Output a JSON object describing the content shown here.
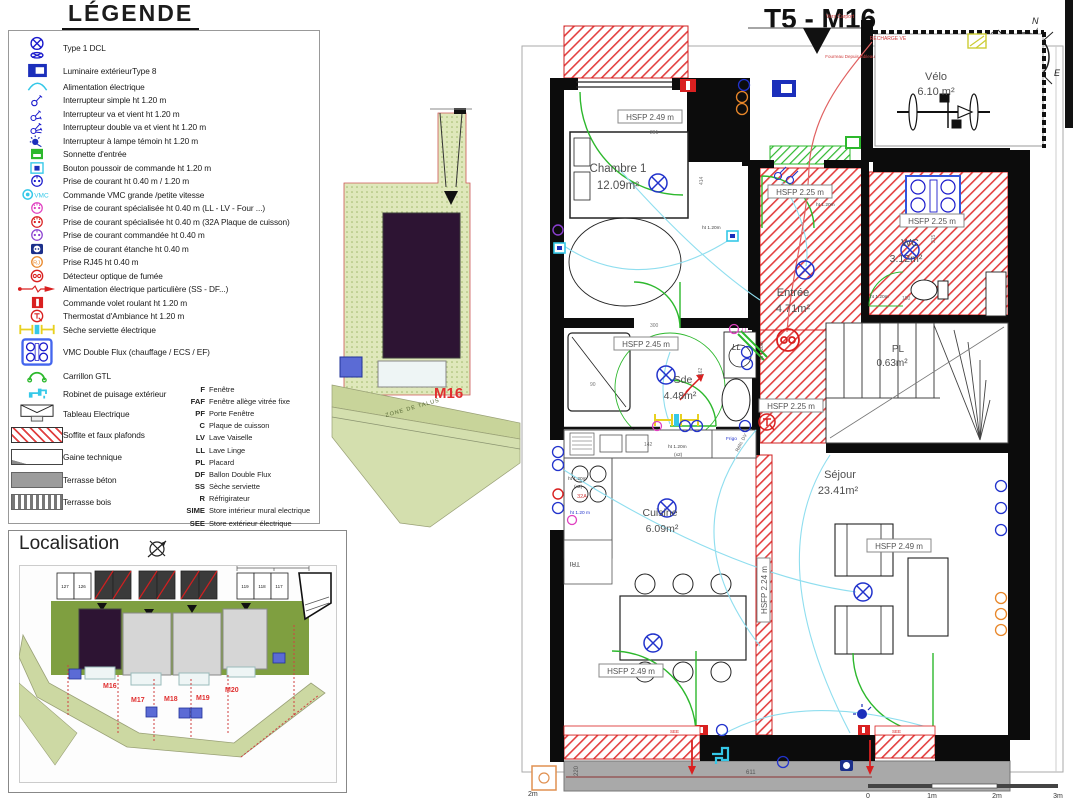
{
  "legend": {
    "title": "LÉGENDE",
    "items": [
      {
        "icon": "dcl",
        "label": "Type 1 DCL"
      },
      {
        "icon": "lum",
        "label": "Luminaire extérieurType 8"
      },
      {
        "icon": "alim",
        "label": "Alimentation électrique"
      },
      {
        "icon": "int1",
        "label": "Interrupteur simple ht 1.20 m"
      },
      {
        "icon": "int2",
        "label": "Interrupteur va et vient ht 1.20 m"
      },
      {
        "icon": "int3",
        "label": "Interrupteur double va et vient ht 1.20 m"
      },
      {
        "icon": "int4",
        "label": "Interrupteur à lampe témoin ht 1.20 m"
      },
      {
        "icon": "sonnette",
        "label": "Sonnette d'entrée"
      },
      {
        "icon": "bouton",
        "label": "Bouton poussoir de commande ht 1.20 m"
      },
      {
        "icon": "prise",
        "label": "Prise de courant ht 0.40 m / 1.20 m"
      },
      {
        "icon": "vmc",
        "label": "Commande VMC grande /petite vitesse"
      },
      {
        "icon": "prisell",
        "label": "Prise de courant spécialisée ht 0.40 m (LL - LV - Four ...)"
      },
      {
        "icon": "prise32",
        "label": "Prise de courant spécialisée ht 0.40 m (32A Plaque de cuisson)"
      },
      {
        "icon": "prisecmd",
        "label": "Prise de courant commandée ht 0.40 m"
      },
      {
        "icon": "priseet",
        "label": "Prise de courant étanche ht 0.40 m"
      },
      {
        "icon": "rj45",
        "label": "Prise RJ45 ht 0.40 m"
      },
      {
        "icon": "do",
        "label": "Détecteur optique de fumée"
      },
      {
        "icon": "alimp",
        "label": "Alimentation électrique particulière (SS - DF...)"
      },
      {
        "icon": "volet",
        "label": "Commande volet roulant ht 1.20 m"
      },
      {
        "icon": "thermo",
        "label": "Thermostat d'Ambiance ht 1.20 m"
      },
      {
        "icon": "seche",
        "label": "Sèche serviette électrique"
      },
      {
        "icon": "vmcdf",
        "label": "VMC Double Flux (chauffage / ECS / EF)"
      },
      {
        "icon": "carillon",
        "label": "Carrillon GTL"
      },
      {
        "icon": "robinet",
        "label": "Robinet de puisage extérieur"
      },
      {
        "icon": "tableau",
        "label": "Tableau Electrique"
      },
      {
        "icon": "soffite",
        "label": "Soffite et faux plafonds"
      },
      {
        "icon": "gaine",
        "label": "Gaine technique"
      },
      {
        "icon": "beton",
        "label": "Terrasse béton"
      },
      {
        "icon": "bois",
        "label": "Terrasse bois"
      }
    ],
    "abbreviations": [
      {
        "code": "F",
        "label": "Fenêtre"
      },
      {
        "code": "FAF",
        "label": "Fenêtre allège vitrée fixe"
      },
      {
        "code": "PF",
        "label": "Porte Fenêtre"
      },
      {
        "code": "C",
        "label": "Plaque de cuisson"
      },
      {
        "code": "LV",
        "label": "Lave Vaiselle"
      },
      {
        "code": "LL",
        "label": "Lave Linge"
      },
      {
        "code": "PL",
        "label": "Placard"
      },
      {
        "code": "DF",
        "label": "Ballon Double Flux"
      },
      {
        "code": "SS",
        "label": "Sèche serviette"
      },
      {
        "code": "R",
        "label": "Réfrigirateur"
      },
      {
        "code": "SIME",
        "label": "Store intérieur mural electrique"
      },
      {
        "code": "SEE",
        "label": "Store extérieur électrique"
      },
      {
        "code": "GDC",
        "label": "Garde Corps"
      }
    ]
  },
  "localisation": {
    "title": "Localisation",
    "buildings": [
      "M16",
      "M17",
      "M18",
      "M19",
      "M20"
    ],
    "parkings": [
      "127",
      "126",
      "119",
      "118",
      "117"
    ]
  },
  "site": {
    "lot": "M16",
    "zone": "ZONE DE TALUS"
  },
  "floor_plan": {
    "title": "T5 - M16",
    "compass": {
      "n": "N",
      "s": "S",
      "e": "E",
      "o": "O"
    },
    "rooms": {
      "chambre": {
        "name": "Chambre 1",
        "area": "12.09m²"
      },
      "velo": {
        "name": "Vélo",
        "area": "6.10 m²"
      },
      "entree": {
        "name": "Entrée",
        "area": "4.71m²"
      },
      "wc": {
        "name": "WC",
        "area": "3.12m²"
      },
      "pl": {
        "name": "PL",
        "area": "0.63m²"
      },
      "sde": {
        "name": "Sde",
        "area": "4.48m²"
      },
      "cuisine": {
        "name": "Cuisine",
        "area": "6.09m²"
      },
      "sejour": {
        "name": "Séjour",
        "area": "23.41m²"
      }
    },
    "hsfp": {
      "h249": "HSFP 2.49 m",
      "h225": "HSFP 2.25 m",
      "h245": "HSFP 2.45 m",
      "h224": "HSFP 2.24 m"
    },
    "ann": {
      "vers": "Vers Carport",
      "recharge": "RECHARGE VE",
      "fourreau": "Fourreau Depuis tableau",
      "ll_tag": "LL",
      "ll_abbr": "LL",
      "tri": "TRI",
      "frigo": "Frigo",
      "refri": "Réfri. DV",
      "see": "SEE",
      "ht120": "ht 1.20m",
      "x2": "(x2)",
      "ht120b": "ht 1.20 m",
      "a32": "32A"
    },
    "dims": {
      "d291": "291",
      "d414": "414",
      "d300": "300",
      "d162": "162",
      "d142": "142",
      "d150": "150",
      "d215": "215",
      "d611": "611",
      "d220": "220",
      "d90": "90"
    },
    "scale": {
      "t0": "0",
      "t1": "1m",
      "t2": "2m",
      "t3": "3m",
      "left": "2m"
    }
  },
  "colors": {
    "accent_red": "#d92020",
    "electric_blue": "#1a1acc",
    "cyan": "#35c8e8",
    "green": "#2db82d",
    "orange": "#e8872a",
    "building_purple": "#2d1433"
  }
}
